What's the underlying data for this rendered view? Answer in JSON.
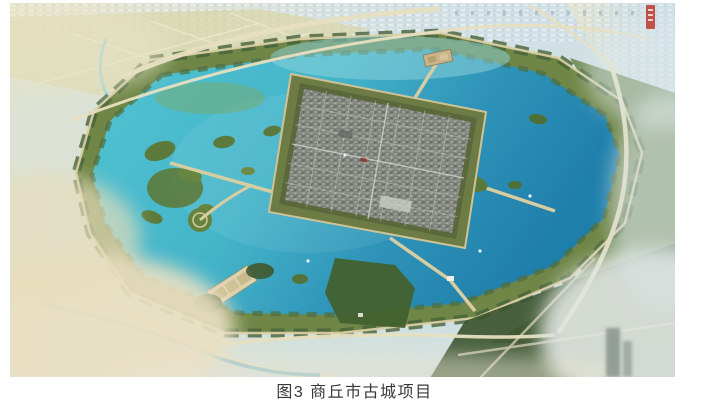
{
  "figure": {
    "caption": "图3 商丘市古城项目"
  },
  "palette": {
    "lake_turquoise": "#52c4d2",
    "lake_deep": "#1f7fab",
    "shore_green": "#6f8647",
    "forest_dark": "#3c5530",
    "ring_road_tan": "#d9cfa2",
    "city_grey": "#7c7f78",
    "haze_yellow": "#e9e0c2",
    "haze_blue": "#d2e0e3",
    "seal_red": "#bf4136",
    "caption_text": "#383838"
  }
}
